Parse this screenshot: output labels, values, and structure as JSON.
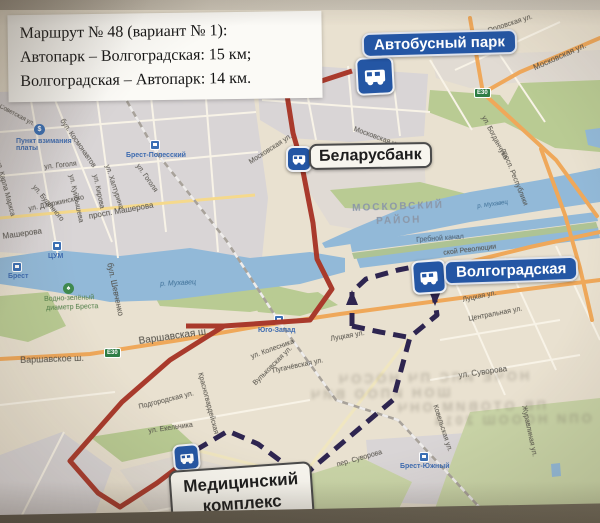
{
  "info_box": {
    "line1": "Маршрут № 48 (вариант № 1):",
    "line2": "Автопарк – Волгоградская:  15 км;",
    "line3": "Волгоградская – Автопарк:  14 км."
  },
  "stop_labels": {
    "autopark": "Автобусный парк",
    "bank": "Беларусбанк",
    "volgogradskaya": "Волгоградская",
    "medical_line1": "Медицинский",
    "medical_line2": "комплекс"
  },
  "colors": {
    "route_solid": "#a93a2c",
    "route_dashed": "#2e2550",
    "marker_blue": "#2456a4",
    "water": "#92b9d8",
    "green": "#b9cb93",
    "road_orange": "#efa85a"
  },
  "routes": {
    "lines": [
      {
        "name": "outbound-solid",
        "color": "#a93a2c",
        "width": 5,
        "dash": null,
        "points": [
          [
            352,
            71
          ],
          [
            300,
            88
          ],
          [
            287,
            95
          ],
          [
            293,
            133
          ],
          [
            301,
            161
          ],
          [
            313,
            223
          ],
          [
            317,
            259
          ],
          [
            332,
            289
          ],
          [
            310,
            320
          ],
          [
            224,
            326
          ],
          [
            170,
            360
          ],
          [
            122,
            402
          ],
          [
            70,
            461
          ],
          [
            98,
            493
          ],
          [
            120,
            507
          ],
          [
            157,
            483
          ],
          [
            186,
            461
          ]
        ]
      },
      {
        "name": "outbound-stub",
        "color": "#a93a2c",
        "width": 5,
        "dash": null,
        "points": [
          [
            186,
            326
          ],
          [
            224,
            326
          ]
        ]
      },
      {
        "name": "return-dashed",
        "color": "#2e2550",
        "width": 5,
        "dash": "13 8",
        "points": [
          [
            196,
            450
          ],
          [
            228,
            431
          ],
          [
            258,
            444
          ],
          [
            302,
            477
          ],
          [
            393,
            400
          ],
          [
            410,
            337
          ],
          [
            437,
            315
          ],
          [
            433,
            288
          ],
          [
            419,
            272
          ]
        ]
      },
      {
        "name": "return-branch",
        "color": "#2e2550",
        "width": 5,
        "dash": "13 8",
        "points": [
          [
            352,
            326
          ],
          [
            352,
            292
          ],
          [
            366,
            279
          ],
          [
            398,
            270
          ],
          [
            413,
            267
          ]
        ]
      },
      {
        "name": "return-connector",
        "color": "#2e2550",
        "width": 5,
        "dash": "13 8",
        "points": [
          [
            352,
            326
          ],
          [
            380,
            332
          ],
          [
            407,
            337
          ]
        ]
      }
    ],
    "arrows": [
      {
        "x": 352,
        "y": 298,
        "dir": "up",
        "color": "#2e2550"
      },
      {
        "x": 435,
        "y": 298,
        "dir": "down",
        "color": "#2e2550"
      }
    ]
  },
  "street_labels": [
    {
      "t": "Орловская ул.",
      "x": 487,
      "y": 28,
      "r": -18,
      "s": 7
    },
    {
      "t": "Московская ул.",
      "x": 532,
      "y": 64,
      "r": -24,
      "s": 8
    },
    {
      "t": "Московская ул.",
      "x": 355,
      "y": 126,
      "r": 20,
      "s": 7
    },
    {
      "t": "Московская ул.",
      "x": 248,
      "y": 160,
      "r": -33,
      "s": 7
    },
    {
      "t": "ул. Богданчука",
      "x": 486,
      "y": 115,
      "r": 62,
      "s": 7
    },
    {
      "t": "просп. Республики",
      "x": 506,
      "y": 148,
      "r": 68,
      "s": 7
    },
    {
      "t": "МОСКОВСКИЙ",
      "x": 352,
      "y": 203,
      "r": -2,
      "s": 10,
      "c": "#8b97a8",
      "ls": 2,
      "b": 1
    },
    {
      "t": "РАЙОН",
      "x": 376,
      "y": 216,
      "r": -2,
      "s": 10,
      "c": "#8b97a8",
      "ls": 2,
      "b": 1
    },
    {
      "t": "Гребной канал",
      "x": 416,
      "y": 237,
      "r": -4,
      "s": 7,
      "c": "#4a5a6a"
    },
    {
      "t": "р. Мухавец",
      "x": 160,
      "y": 281,
      "r": -3,
      "s": 7,
      "c": "#3c6e96",
      "i": 1
    },
    {
      "t": "р. Мухавец",
      "x": 477,
      "y": 204,
      "r": -8,
      "s": 6,
      "c": "#3c6e96",
      "i": 1
    },
    {
      "t": "ской Революции",
      "x": 443,
      "y": 250,
      "r": -7,
      "s": 7
    },
    {
      "t": "Луцкая ул.",
      "x": 462,
      "y": 297,
      "r": -12,
      "s": 7
    },
    {
      "t": "Луцкая ул.",
      "x": 330,
      "y": 336,
      "r": -10,
      "s": 7
    },
    {
      "t": "Центральная ул.",
      "x": 468,
      "y": 316,
      "r": -11,
      "s": 7
    },
    {
      "t": "ул. Суворова",
      "x": 458,
      "y": 371,
      "r": -8,
      "s": 8
    },
    {
      "t": "пер. Суворова",
      "x": 336,
      "y": 462,
      "r": -16,
      "s": 7
    },
    {
      "t": "Ковельская ул.",
      "x": 438,
      "y": 404,
      "r": 72,
      "s": 7
    },
    {
      "t": "Журавлиная ул.",
      "x": 527,
      "y": 405,
      "r": 78,
      "s": 7
    },
    {
      "t": "Подгородская ул.",
      "x": 138,
      "y": 404,
      "r": -14,
      "s": 7
    },
    {
      "t": "ул. Екельчика",
      "x": 148,
      "y": 428,
      "r": -8,
      "s": 7
    },
    {
      "t": "Красногвардейская",
      "x": 203,
      "y": 372,
      "r": 75,
      "s": 7
    },
    {
      "t": "ул. Колесника",
      "x": 250,
      "y": 354,
      "r": -20,
      "s": 7
    },
    {
      "t": "Пугачёвская ул.",
      "x": 272,
      "y": 368,
      "r": -12,
      "s": 7
    },
    {
      "t": "Вульковская ул.",
      "x": 252,
      "y": 382,
      "r": -45,
      "s": 7
    },
    {
      "t": "Варшавское ш.",
      "x": 20,
      "y": 355,
      "r": -2,
      "s": 9
    },
    {
      "t": "Варшавская ш.",
      "x": 138,
      "y": 336,
      "r": -8,
      "s": 10
    },
    {
      "t": "бул. Шевченко",
      "x": 114,
      "y": 262,
      "r": 78,
      "s": 8
    },
    {
      "t": "просп. Машерова",
      "x": 88,
      "y": 212,
      "r": -10,
      "s": 8
    },
    {
      "t": "Машерова",
      "x": 2,
      "y": 232,
      "r": -8,
      "s": 8
    },
    {
      "t": "ул. Дзержинского",
      "x": 28,
      "y": 206,
      "r": -12,
      "s": 7
    },
    {
      "t": "ул. Гоголя",
      "x": 44,
      "y": 164,
      "r": -6,
      "s": 7
    },
    {
      "t": "ул. Гоголя",
      "x": 140,
      "y": 163,
      "r": 55,
      "s": 7
    },
    {
      "t": "ул. Будённого",
      "x": 36,
      "y": 184,
      "r": 50,
      "s": 7
    },
    {
      "t": "бул. Космонавтов",
      "x": 64,
      "y": 118,
      "r": 55,
      "s": 7
    },
    {
      "t": "ул. Куйбышева",
      "x": 74,
      "y": 174,
      "r": 78,
      "s": 7
    },
    {
      "t": "ул. Кирова",
      "x": 98,
      "y": 174,
      "r": 78,
      "s": 7
    },
    {
      "t": "ул. Халтурина",
      "x": 110,
      "y": 164,
      "r": 72,
      "s": 7
    },
    {
      "t": "ул. Карла Маркса",
      "x": 1,
      "y": 160,
      "r": 75,
      "s": 7
    },
    {
      "t": "Советская ул.",
      "x": 1,
      "y": 104,
      "r": 28,
      "s": 6
    },
    {
      "t": "Водно-зелёный",
      "x": 44,
      "y": 296,
      "r": -2,
      "s": 7,
      "c": "#4e7d46"
    },
    {
      "t": "диаметр Бреста",
      "x": 46,
      "y": 305,
      "r": -2,
      "s": 7,
      "c": "#4e7d46"
    }
  ],
  "stations": [
    {
      "name": "Брест-Полесский",
      "x": 150,
      "y": 140,
      "tx": 126,
      "ty": 152
    },
    {
      "name": "Брест",
      "x": 12,
      "y": 262,
      "tx": 8,
      "ty": 273
    },
    {
      "name": "ЦУМ",
      "x": 52,
      "y": 241,
      "tx": 48,
      "ty": 253
    },
    {
      "name": "Юго-Запад",
      "x": 274,
      "y": 315,
      "tx": 258,
      "ty": 327
    },
    {
      "name": "Брест-Южный",
      "x": 419,
      "y": 452,
      "tx": 400,
      "ty": 463
    }
  ],
  "pois": [
    {
      "kind": "toll",
      "x": 34,
      "y": 124,
      "glyph": "$",
      "color": "#3a6fb5",
      "text1": "Пункт взимания",
      "text2": "платы",
      "tx": 16,
      "ty": 138
    },
    {
      "kind": "park",
      "x": 63,
      "y": 283,
      "glyph": "♠",
      "color": "#3f8a4f",
      "text1": "",
      "text2": "",
      "tx": 0,
      "ty": 0
    }
  ],
  "road_badges": [
    {
      "label": "E30",
      "x": 104,
      "y": 348
    },
    {
      "label": "E30",
      "x": 474,
      "y": 88
    }
  ],
  "ghost_text": [
    {
      "t": "ШОН ИПОО ВИЧ",
      "x": 308,
      "y": 386
    },
    {
      "t": "НОЧЕ ИЛС ПЧ НОСОЧ",
      "x": 336,
      "y": 370
    },
    {
      "t": "ПВ ОТОВИМ ОНЧ",
      "x": 395,
      "y": 399
    },
    {
      "t": "ОПИ НОООШ 2014",
      "x": 432,
      "y": 412
    }
  ]
}
